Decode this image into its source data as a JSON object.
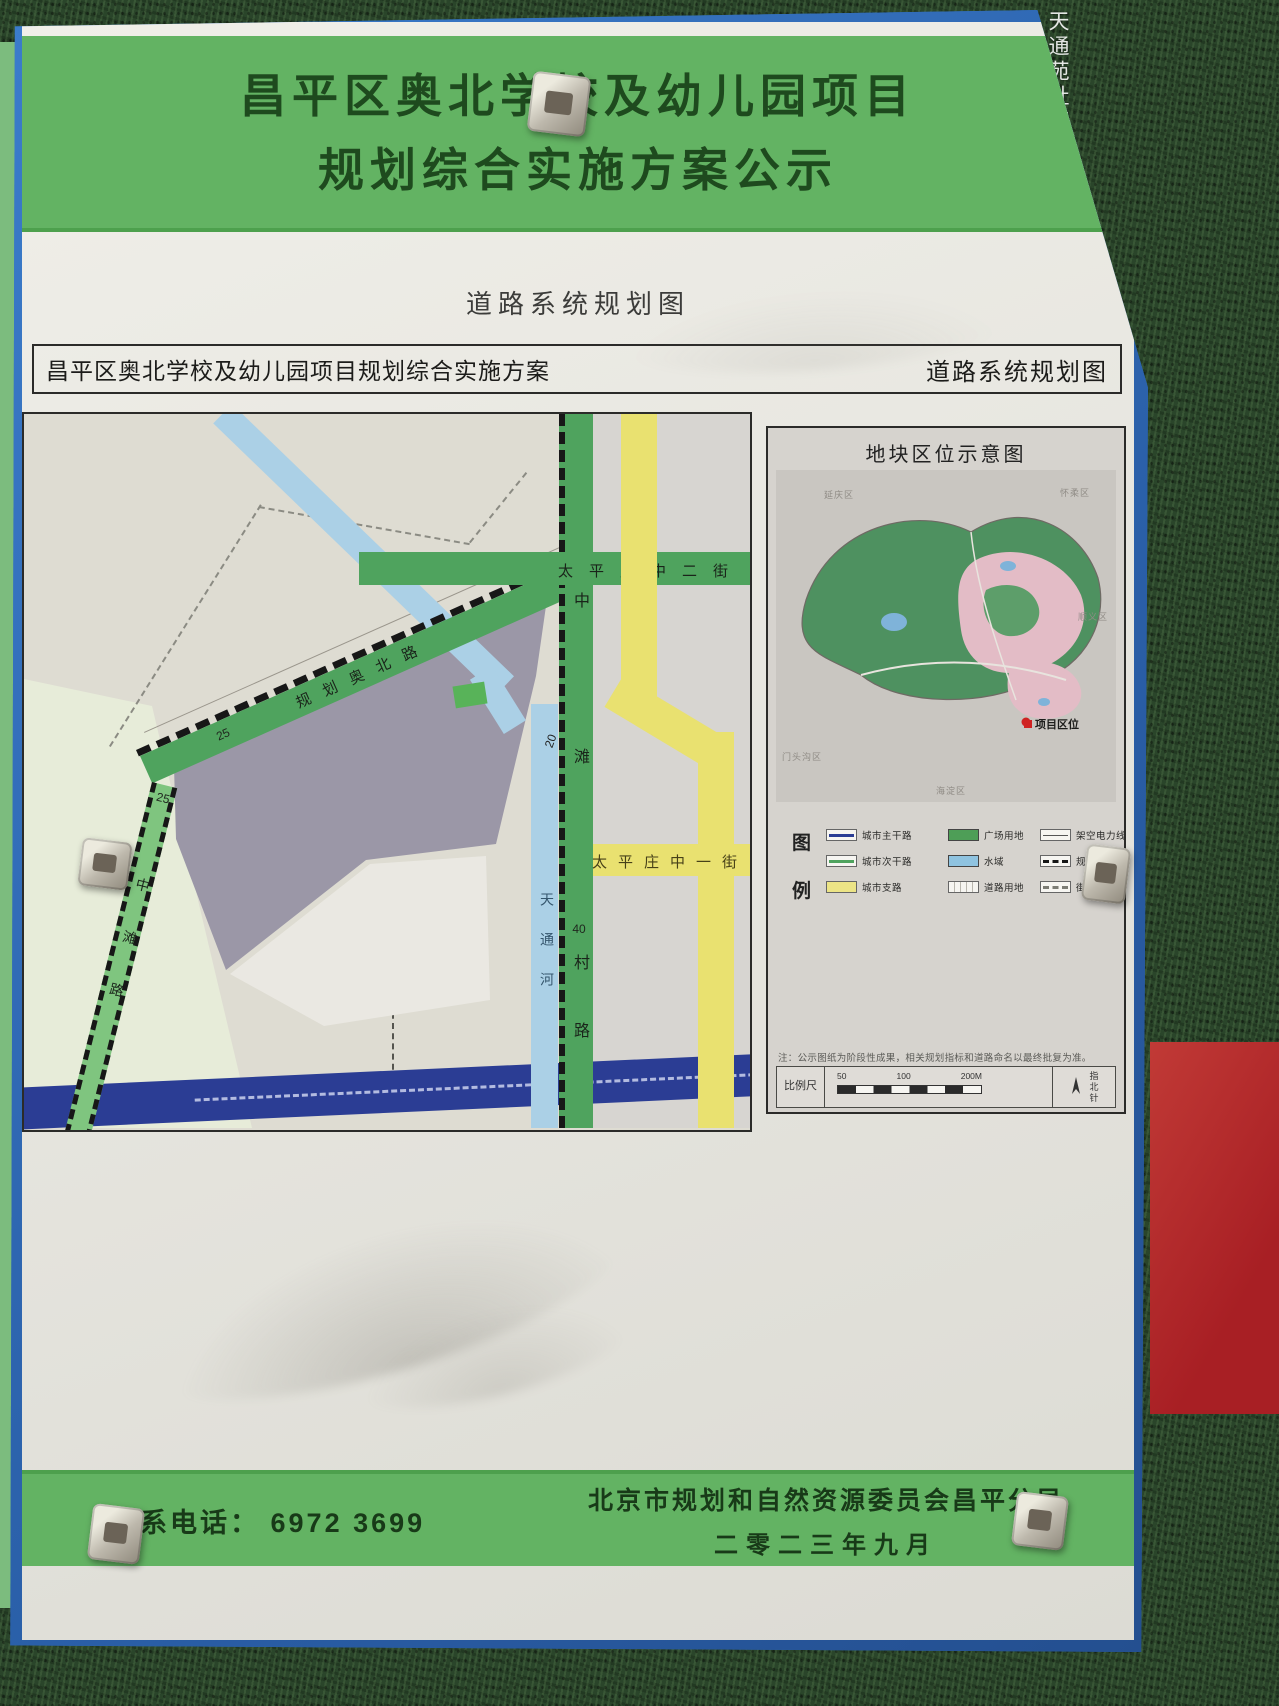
{
  "watermark": "天通苑社区网",
  "header": {
    "title_line1": "昌平区奥北学校及幼儿园项目",
    "title_line2": "规划综合实施方案公示",
    "page_caption": "道路系统规划图",
    "bar_left": "昌平区奥北学校及幼儿园项目规划综合实施方案",
    "bar_right": "道路系统规划图"
  },
  "map": {
    "roads": {
      "aobei": "规划奥北路",
      "aobei_width": "25",
      "taiping_2nd": "太平庄中二街",
      "taiping_1st": "太平庄中一街",
      "zhongtan_village_top": "中滩",
      "zhongtan_village_width": "40",
      "zhongtan_village_bottom": "村路",
      "zhongtan": "中滩路",
      "zhongtan_width": "25",
      "river": "天通河",
      "marker_20": "20"
    }
  },
  "inset": {
    "title": "地块区位示意图",
    "districts": [
      "延庆区",
      "怀柔区",
      "顺义区",
      "门头沟区",
      "海淀区"
    ],
    "marker": "项目区位"
  },
  "legend": {
    "label_top": "图",
    "label_bottom": "例",
    "items": [
      "城市主干路",
      "城市次干路",
      "城市支路",
      "广场用地",
      "水域",
      "道路用地",
      "架空电力线",
      "规划范围",
      "街区范围"
    ]
  },
  "note": "注：公示图纸为阶段性成果，相关规划指标和道路命名以最终批复为准。",
  "scalebar": {
    "label": "比例尺",
    "t1": "50",
    "t2": "100",
    "t3": "200M",
    "compass": "指北针"
  },
  "footer": {
    "contact_label": "联系电话：",
    "contact_number": "6972 3699",
    "org": "北京市规划和自然资源委员会昌平分局",
    "date": "二零二三年九月"
  },
  "colors": {
    "band_green": "#63b363",
    "frame_blue": "#2e6ab8",
    "main_road_blue": "#2b3d94",
    "secondary_road_green": "#4fa35e",
    "branch_road_yellow": "#e9e170",
    "water_blue": "#abd0e6",
    "plot_purple": "#9b97a7",
    "red_panel_red": "#c0392b"
  }
}
